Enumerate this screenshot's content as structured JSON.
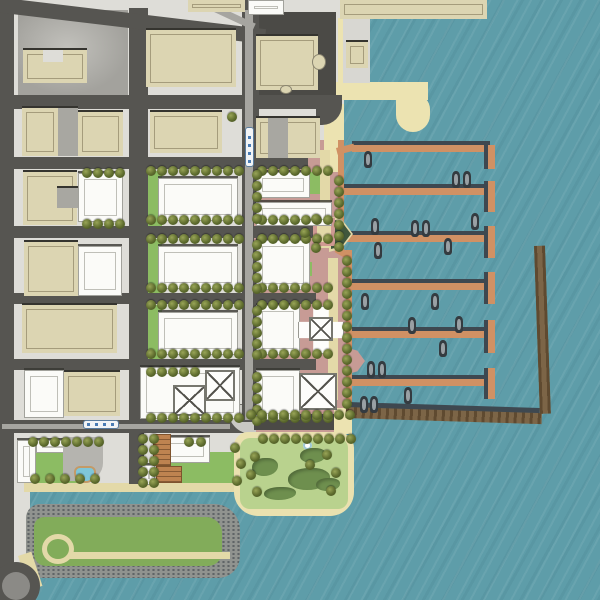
{
  "meta": {
    "title": "Waterfront district illustrated site plan",
    "description": "Aerial-style rendered master plan: city street grid with existing tan buildings, new white development blocks with lawns and street trees, pink waterfront esplanade, marina with six piers and docked boats, L-shaped breakwater, central waterfront park with pond lawn, and a riprap-edged green peninsula along a south channel."
  },
  "palette": {
    "water": "#5E9DA9",
    "sidewalk": "#DEDDD8",
    "asphalt": "#565551",
    "beige": "#DCD5B2",
    "lawn": "#8CBC63",
    "pink": "#C79B95",
    "tanwalk": "#E3D9A8",
    "sand": "#ECE3B1",
    "pier": "#D09164",
    "breakwater": "#7C6547",
    "tree_olive": "#5E6C2E",
    "shrub_green": "#6E8F4E",
    "park_green": "#B9D28E",
    "pool_blue": "#7FC6D9"
  },
  "shapes": [
    [
      "side",
      0,
      0,
      344,
      437,
      0,
      "mainland"
    ],
    [
      "side",
      0,
      437,
      240,
      55,
      0,
      "waterfront-strip"
    ],
    [
      "side",
      0,
      492,
      30,
      108,
      0,
      "south-street-strip"
    ],
    [
      "lotl",
      18,
      10,
      110,
      85,
      0,
      "parking-lot-nw"
    ],
    [
      "lot",
      250,
      12,
      86,
      83,
      0,
      "parking-lot-ne"
    ],
    [
      "pink",
      252,
      168,
      82,
      59,
      0,
      "block-paving"
    ],
    [
      "pink",
      252,
      238,
      82,
      55,
      0,
      "block-paving"
    ],
    [
      "pink",
      252,
      303,
      82,
      57,
      0,
      "block-paving"
    ],
    [
      "pink",
      252,
      368,
      82,
      57,
      0,
      "block-paving"
    ],
    [
      "pink",
      308,
      140,
      36,
      112,
      0,
      "esplanade-north"
    ],
    [
      "pink",
      316,
      250,
      36,
      160,
      0,
      "esplanade-south"
    ],
    [
      "pink",
      258,
      438,
      11,
      58,
      0,
      "park-path"
    ],
    [
      "pink",
      262,
      492,
      18,
      9,
      0,
      "park-path"
    ],
    [
      "lawn",
      148,
      171,
      14,
      55,
      0,
      "lawn"
    ],
    [
      "lawn",
      148,
      239,
      14,
      54,
      0,
      "lawn"
    ],
    [
      "lawn",
      148,
      305,
      14,
      54,
      0,
      "lawn"
    ],
    [
      "lawn",
      142,
      370,
      18,
      15,
      0,
      "lawn"
    ],
    [
      "lawn",
      175,
      397,
      32,
      18,
      0,
      "lawn"
    ],
    [
      "lawn",
      168,
      452,
      78,
      36,
      0,
      "lawn"
    ],
    [
      "lawn",
      36,
      453,
      42,
      32,
      0,
      "lawn"
    ],
    [
      "lawn",
      310,
      172,
      12,
      22,
      0,
      "lawn"
    ],
    [
      "lawn",
      296,
      262,
      16,
      14,
      0,
      "lawn"
    ],
    [
      "lawn",
      238,
      442,
      18,
      18,
      0,
      "lawn"
    ],
    [
      "sand",
      338,
      18,
      10,
      82,
      0,
      "beach-strip"
    ],
    [
      "sand",
      324,
      104,
      20,
      68,
      0,
      "beach-strip"
    ],
    [
      "sand",
      336,
      82,
      92,
      18,
      0,
      "beach-hook"
    ],
    [
      "sandblob",
      396,
      94,
      34,
      38,
      0,
      "beach-hook-tip"
    ],
    [
      "tan",
      24,
      483,
      216,
      9,
      0,
      "waterfront-path"
    ],
    [
      "tan",
      320,
      150,
      10,
      98,
      0,
      "esplanade-walk"
    ],
    [
      "tan",
      328,
      258,
      10,
      142,
      0,
      "esplanade-walk"
    ],
    [
      "rip",
      26,
      504,
      214,
      74,
      0,
      "peninsula-riprap"
    ],
    [
      "pen",
      34,
      517,
      188,
      49,
      0,
      "peninsula-green"
    ],
    [
      "tanring",
      42,
      534,
      32,
      30,
      0,
      "path-loop"
    ],
    [
      "tan",
      70,
      552,
      160,
      7,
      0,
      "peninsula-path"
    ],
    [
      "tan2",
      18,
      556,
      14,
      36,
      -18,
      "path-spur"
    ],
    [
      "street",
      0,
      95,
      340,
      14,
      0,
      "street-e1"
    ],
    [
      "streetbend",
      316,
      95,
      26,
      30,
      0,
      "street-bend"
    ],
    [
      "street",
      0,
      157,
      308,
      12,
      0,
      "street-e2"
    ],
    [
      "street",
      0,
      226,
      316,
      12,
      0,
      "street-e3"
    ],
    [
      "street",
      0,
      293,
      316,
      11,
      0,
      "street-e4"
    ],
    [
      "street",
      0,
      359,
      316,
      11,
      0,
      "street-e5"
    ],
    [
      "street",
      0,
      420,
      250,
      13,
      0,
      "street-e6"
    ],
    [
      "conc",
      228,
      404,
      28,
      30,
      0,
      "street-curve"
    ],
    [
      "street",
      0,
      0,
      14,
      578,
      0,
      "street-n1"
    ],
    [
      "street",
      129,
      8,
      19,
      414,
      0,
      "street-n2"
    ],
    [
      "street",
      129,
      432,
      15,
      52,
      0,
      "street-n2-stub"
    ],
    [
      "street",
      242,
      0,
      17,
      422,
      0,
      "street-n3-transit"
    ],
    [
      "street",
      -4,
      -3,
      272,
      15,
      6.8,
      "street-diagonal"
    ],
    [
      "circle-street",
      -8,
      562,
      48,
      48,
      0,
      "roundabout"
    ],
    [
      "circle-inner",
      2,
      572,
      28,
      28,
      0,
      "roundabout-center"
    ],
    [
      "track",
      245,
      10,
      8,
      410,
      0,
      "tram-track"
    ],
    [
      "track",
      205,
      0,
      56,
      7,
      25,
      "tram-track-curve"
    ],
    [
      "track",
      2,
      424,
      228,
      5,
      0,
      "tram-track-west"
    ],
    [
      "pinkband",
      254,
      222,
      62,
      4,
      0,
      "gateway-band"
    ],
    [
      "pinkband",
      254,
      238,
      62,
      4,
      0,
      "gateway-band"
    ],
    [
      "pink",
      256,
      408,
      96,
      26,
      0,
      "esplanade-bottom"
    ],
    [
      "lot",
      254,
      414,
      82,
      16,
      0,
      "overlook-plaza"
    ],
    [
      "sand",
      334,
      408,
      18,
      26,
      0,
      "shore-path"
    ],
    [
      "parksand",
      234,
      432,
      120,
      84,
      0,
      "park-edge"
    ],
    [
      "parkgreen",
      240,
      438,
      108,
      71,
      0,
      "park-lawn"
    ],
    [
      "psh",
      352,
      141,
      138,
      4,
      0,
      "pier-shadow"
    ],
    [
      "pier",
      352,
      145,
      138,
      7,
      0,
      "pier-1"
    ],
    [
      "capsh",
      484,
      145,
      4,
      24,
      0,
      "cap-shadow"
    ],
    [
      "cap",
      488,
      145,
      7,
      24,
      0,
      "pier-1-cap"
    ],
    [
      "psh",
      344,
      184,
      146,
      4,
      0,
      "pier-shadow"
    ],
    [
      "pier",
      344,
      188,
      146,
      7,
      0,
      "pier-2"
    ],
    [
      "capsh",
      484,
      181,
      4,
      31,
      0,
      "cap-shadow"
    ],
    [
      "cap",
      488,
      181,
      7,
      31,
      0,
      "pier-2-cap"
    ],
    [
      "psh",
      344,
      231,
      146,
      4,
      0,
      "pier-shadow"
    ],
    [
      "pier",
      344,
      235,
      146,
      7,
      0,
      "pier-3"
    ],
    [
      "capsh",
      484,
      226,
      4,
      32,
      0,
      "cap-shadow"
    ],
    [
      "cap",
      488,
      226,
      7,
      32,
      0,
      "pier-3-cap"
    ],
    [
      "psh",
      352,
      279,
      138,
      4,
      0,
      "pier-shadow"
    ],
    [
      "pier",
      352,
      283,
      138,
      7,
      0,
      "pier-4"
    ],
    [
      "capsh",
      484,
      272,
      4,
      32,
      0,
      "cap-shadow"
    ],
    [
      "cap",
      488,
      272,
      7,
      32,
      0,
      "pier-4-cap"
    ],
    [
      "psh",
      352,
      327,
      138,
      4,
      0,
      "pier-shadow"
    ],
    [
      "pier",
      352,
      331,
      138,
      7,
      0,
      "pier-5"
    ],
    [
      "capsh",
      484,
      320,
      4,
      33,
      0,
      "cap-shadow"
    ],
    [
      "cap",
      488,
      320,
      7,
      33,
      0,
      "pier-5-cap"
    ],
    [
      "psh",
      352,
      375,
      138,
      4,
      0,
      "pier-shadow"
    ],
    [
      "pier",
      352,
      379,
      138,
      7,
      0,
      "pier-6"
    ],
    [
      "capsh",
      484,
      368,
      4,
      31,
      0,
      "cap-shadow"
    ],
    [
      "cap",
      488,
      368,
      7,
      31,
      0,
      "pier-6-cap"
    ],
    [
      "pier",
      338,
      140,
      6,
      112,
      0,
      "seawall-walk-north"
    ],
    [
      "pier",
      346,
      250,
      6,
      158,
      0,
      "seawall-walk-south"
    ],
    [
      "pier",
      338,
      246,
      16,
      7,
      30,
      "walk-connector"
    ],
    [
      "pier",
      336,
      148,
      18,
      7,
      -14,
      "walk-connector"
    ],
    [
      "bwsh",
      348,
      402,
      192,
      6,
      1.8,
      "breakwater-shadow"
    ],
    [
      "bw",
      346,
      407,
      196,
      11,
      1.8,
      "breakwater-south"
    ],
    [
      "bw",
      534,
      246,
      11,
      168,
      -2,
      "breakwater-east"
    ],
    [
      "wedgeb",
      329,
      216,
      24,
      36,
      0,
      "overlook-wedge-rim"
    ],
    [
      "wedge",
      331,
      219,
      20,
      30,
      0,
      "overlook-wedge"
    ],
    [
      "wedge2",
      348,
      348,
      17,
      26,
      0,
      "esplanade-notch"
    ],
    [
      "gate",
      313,
      218,
      22,
      28,
      0,
      "pier-gateway-deck"
    ],
    [
      "beige",
      340,
      0,
      147,
      19,
      0,
      "building"
    ],
    [
      "beige",
      188,
      0,
      57,
      12,
      0,
      "building"
    ],
    [
      "wb",
      248,
      0,
      36,
      15,
      0,
      "building"
    ],
    [
      "beige",
      146,
      30,
      90,
      57,
      0,
      "building"
    ],
    [
      "beige",
      23,
      50,
      64,
      33,
      0,
      "building-u"
    ],
    [
      "side",
      43,
      50,
      20,
      12,
      0,
      "building-notch"
    ],
    [
      "beige",
      22,
      108,
      36,
      48,
      0,
      "building"
    ],
    [
      "grayb",
      58,
      108,
      20,
      48,
      0,
      "building-wing"
    ],
    [
      "beige",
      78,
      112,
      45,
      44,
      0,
      "building"
    ],
    [
      "beige",
      150,
      112,
      72,
      41,
      0,
      "building"
    ],
    [
      "beige",
      256,
      118,
      64,
      40,
      0,
      "building"
    ],
    [
      "grayb",
      268,
      118,
      20,
      40,
      0,
      "building-wing"
    ],
    [
      "beige",
      256,
      36,
      62,
      54,
      0,
      "landmark-hall"
    ],
    [
      "apse",
      312,
      54,
      14,
      16,
      0,
      "landmark-apse"
    ],
    [
      "apse",
      280,
      85,
      12,
      9,
      0,
      "landmark-entry"
    ],
    [
      "beige",
      23,
      172,
      54,
      53,
      0,
      "building"
    ],
    [
      "grayb",
      57,
      188,
      25,
      20,
      0,
      "building-wing"
    ],
    [
      "beige",
      24,
      242,
      54,
      54,
      0,
      "building"
    ],
    [
      "beige",
      22,
      305,
      95,
      48,
      0,
      "building"
    ],
    [
      "beige",
      64,
      372,
      56,
      44,
      0,
      "building"
    ],
    [
      "conc2",
      343,
      19,
      27,
      64,
      0,
      "shore-platform"
    ],
    [
      "beige",
      346,
      42,
      22,
      26,
      0,
      "shore-pavilion"
    ],
    [
      "wb",
      78,
      173,
      45,
      49,
      0,
      "new-building"
    ],
    [
      "wb",
      78,
      246,
      44,
      50,
      0,
      "new-building"
    ],
    [
      "wb",
      24,
      370,
      40,
      48,
      0,
      "new-building"
    ],
    [
      "wb",
      158,
      178,
      80,
      43,
      0,
      "new-building"
    ],
    [
      "wb",
      158,
      246,
      80,
      43,
      0,
      "new-building"
    ],
    [
      "wb",
      158,
      312,
      80,
      43,
      0,
      "new-building"
    ],
    [
      "wb",
      140,
      367,
      100,
      52,
      0,
      "new-building-podium"
    ],
    [
      "wb",
      256,
      172,
      54,
      26,
      0,
      "new-building"
    ],
    [
      "wb",
      256,
      202,
      76,
      24,
      0,
      "new-building"
    ],
    [
      "wb",
      256,
      240,
      54,
      50,
      0,
      "new-building"
    ],
    [
      "wb",
      256,
      305,
      44,
      50,
      0,
      "new-building"
    ],
    [
      "wb",
      256,
      370,
      44,
      50,
      0,
      "new-building"
    ],
    [
      "wb",
      163,
      437,
      47,
      26,
      0,
      "new-building"
    ],
    [
      "wb",
      142,
      465,
      13,
      20,
      0,
      "new-building"
    ],
    [
      "wb",
      17,
      440,
      19,
      43,
      0,
      "new-building"
    ],
    [
      "wb",
      36,
      440,
      41,
      13,
      0,
      "new-building"
    ],
    [
      "gplaza",
      63,
      437,
      40,
      44,
      0,
      "plaza-terrace"
    ],
    [
      "pool",
      74,
      466,
      22,
      17,
      0,
      "terrace-pool"
    ],
    [
      "tower",
      173,
      385,
      33,
      31,
      0,
      "tower-roof"
    ],
    [
      "tower",
      205,
      370,
      30,
      31,
      0,
      "tower-roof"
    ],
    [
      "tower",
      299,
      373,
      38,
      37,
      0,
      "tower-roof"
    ],
    [
      "crossplate",
      298,
      306,
      46,
      48,
      0,
      "cross-building"
    ],
    [
      "tower",
      309,
      317,
      24,
      24,
      0,
      "tower-roof"
    ],
    [
      "perg",
      153,
      434,
      18,
      32,
      0,
      "pergola"
    ],
    [
      "perg",
      156,
      466,
      26,
      17,
      0,
      "pergola"
    ],
    [
      "fount",
      303,
      441,
      9,
      9,
      0,
      "fountain"
    ],
    [
      "shrub",
      252,
      458,
      26,
      18,
      0,
      "shrub-mass"
    ],
    [
      "shrub",
      288,
      468,
      42,
      22,
      0,
      "shrub-mass"
    ],
    [
      "shrub",
      300,
      448,
      26,
      15,
      0,
      "shrub-mass"
    ],
    [
      "shrub",
      264,
      487,
      32,
      13,
      0,
      "shrub-mass"
    ],
    [
      "shrub",
      316,
      478,
      24,
      13,
      0,
      "shrub-mass"
    ],
    [
      "tram-v",
      245,
      127,
      9,
      40,
      0,
      "tram-north-south"
    ],
    [
      "tram-h",
      83,
      420,
      36,
      9,
      0,
      "tram-east-west"
    ]
  ],
  "trees": {
    "diameter": 10,
    "rows": [
      [
        146,
        166,
        9,
        11,
        0
      ],
      [
        146,
        215,
        9,
        11,
        0
      ],
      [
        146,
        234,
        9,
        11,
        0
      ],
      [
        146,
        283,
        9,
        11,
        0
      ],
      [
        146,
        300,
        9,
        11,
        0
      ],
      [
        146,
        349,
        9,
        11,
        0
      ],
      [
        146,
        367,
        5,
        11,
        0
      ],
      [
        146,
        413,
        9,
        11,
        0
      ],
      [
        257,
        166,
        7,
        11,
        0
      ],
      [
        257,
        215,
        7,
        11,
        0
      ],
      [
        257,
        234,
        7,
        11,
        0
      ],
      [
        257,
        283,
        7,
        11,
        0
      ],
      [
        257,
        300,
        7,
        11,
        0
      ],
      [
        257,
        349,
        7,
        11,
        0
      ],
      [
        257,
        413,
        7,
        11,
        0
      ],
      [
        252,
        170,
        5,
        0,
        11
      ],
      [
        252,
        240,
        5,
        0,
        11
      ],
      [
        252,
        306,
        5,
        0,
        11
      ],
      [
        252,
        372,
        5,
        0,
        11
      ],
      [
        334,
        176,
        7,
        0,
        11
      ],
      [
        342,
        256,
        14,
        0,
        11
      ],
      [
        138,
        434,
        5,
        0,
        11
      ],
      [
        149,
        434,
        5,
        0,
        11
      ],
      [
        246,
        410,
        10,
        11,
        0
      ],
      [
        258,
        434,
        9,
        11,
        0
      ],
      [
        28,
        437,
        7,
        11,
        0
      ],
      [
        30,
        474,
        5,
        15,
        0
      ],
      [
        82,
        168,
        4,
        11,
        0
      ],
      [
        82,
        219,
        4,
        11,
        0
      ]
    ],
    "singles": [
      [
        300,
        228
      ],
      [
        227,
        112
      ],
      [
        184,
        437
      ],
      [
        196,
        437
      ],
      [
        230,
        443
      ],
      [
        236,
        459
      ],
      [
        232,
        476
      ],
      [
        250,
        452
      ],
      [
        246,
        470
      ],
      [
        252,
        487
      ],
      [
        322,
        450
      ],
      [
        331,
        468
      ],
      [
        326,
        486
      ],
      [
        305,
        460
      ],
      [
        311,
        214
      ],
      [
        311,
        243
      ]
    ]
  },
  "boats": [
    [
      364,
      151
    ],
    [
      452,
      171
    ],
    [
      463,
      171
    ],
    [
      371,
      218
    ],
    [
      411,
      220
    ],
    [
      422,
      220
    ],
    [
      471,
      213
    ],
    [
      374,
      242
    ],
    [
      444,
      238
    ],
    [
      361,
      293
    ],
    [
      431,
      293
    ],
    [
      408,
      317
    ],
    [
      455,
      316
    ],
    [
      439,
      340
    ],
    [
      367,
      361
    ],
    [
      378,
      361
    ],
    [
      360,
      396
    ],
    [
      370,
      396
    ],
    [
      404,
      387
    ]
  ]
}
